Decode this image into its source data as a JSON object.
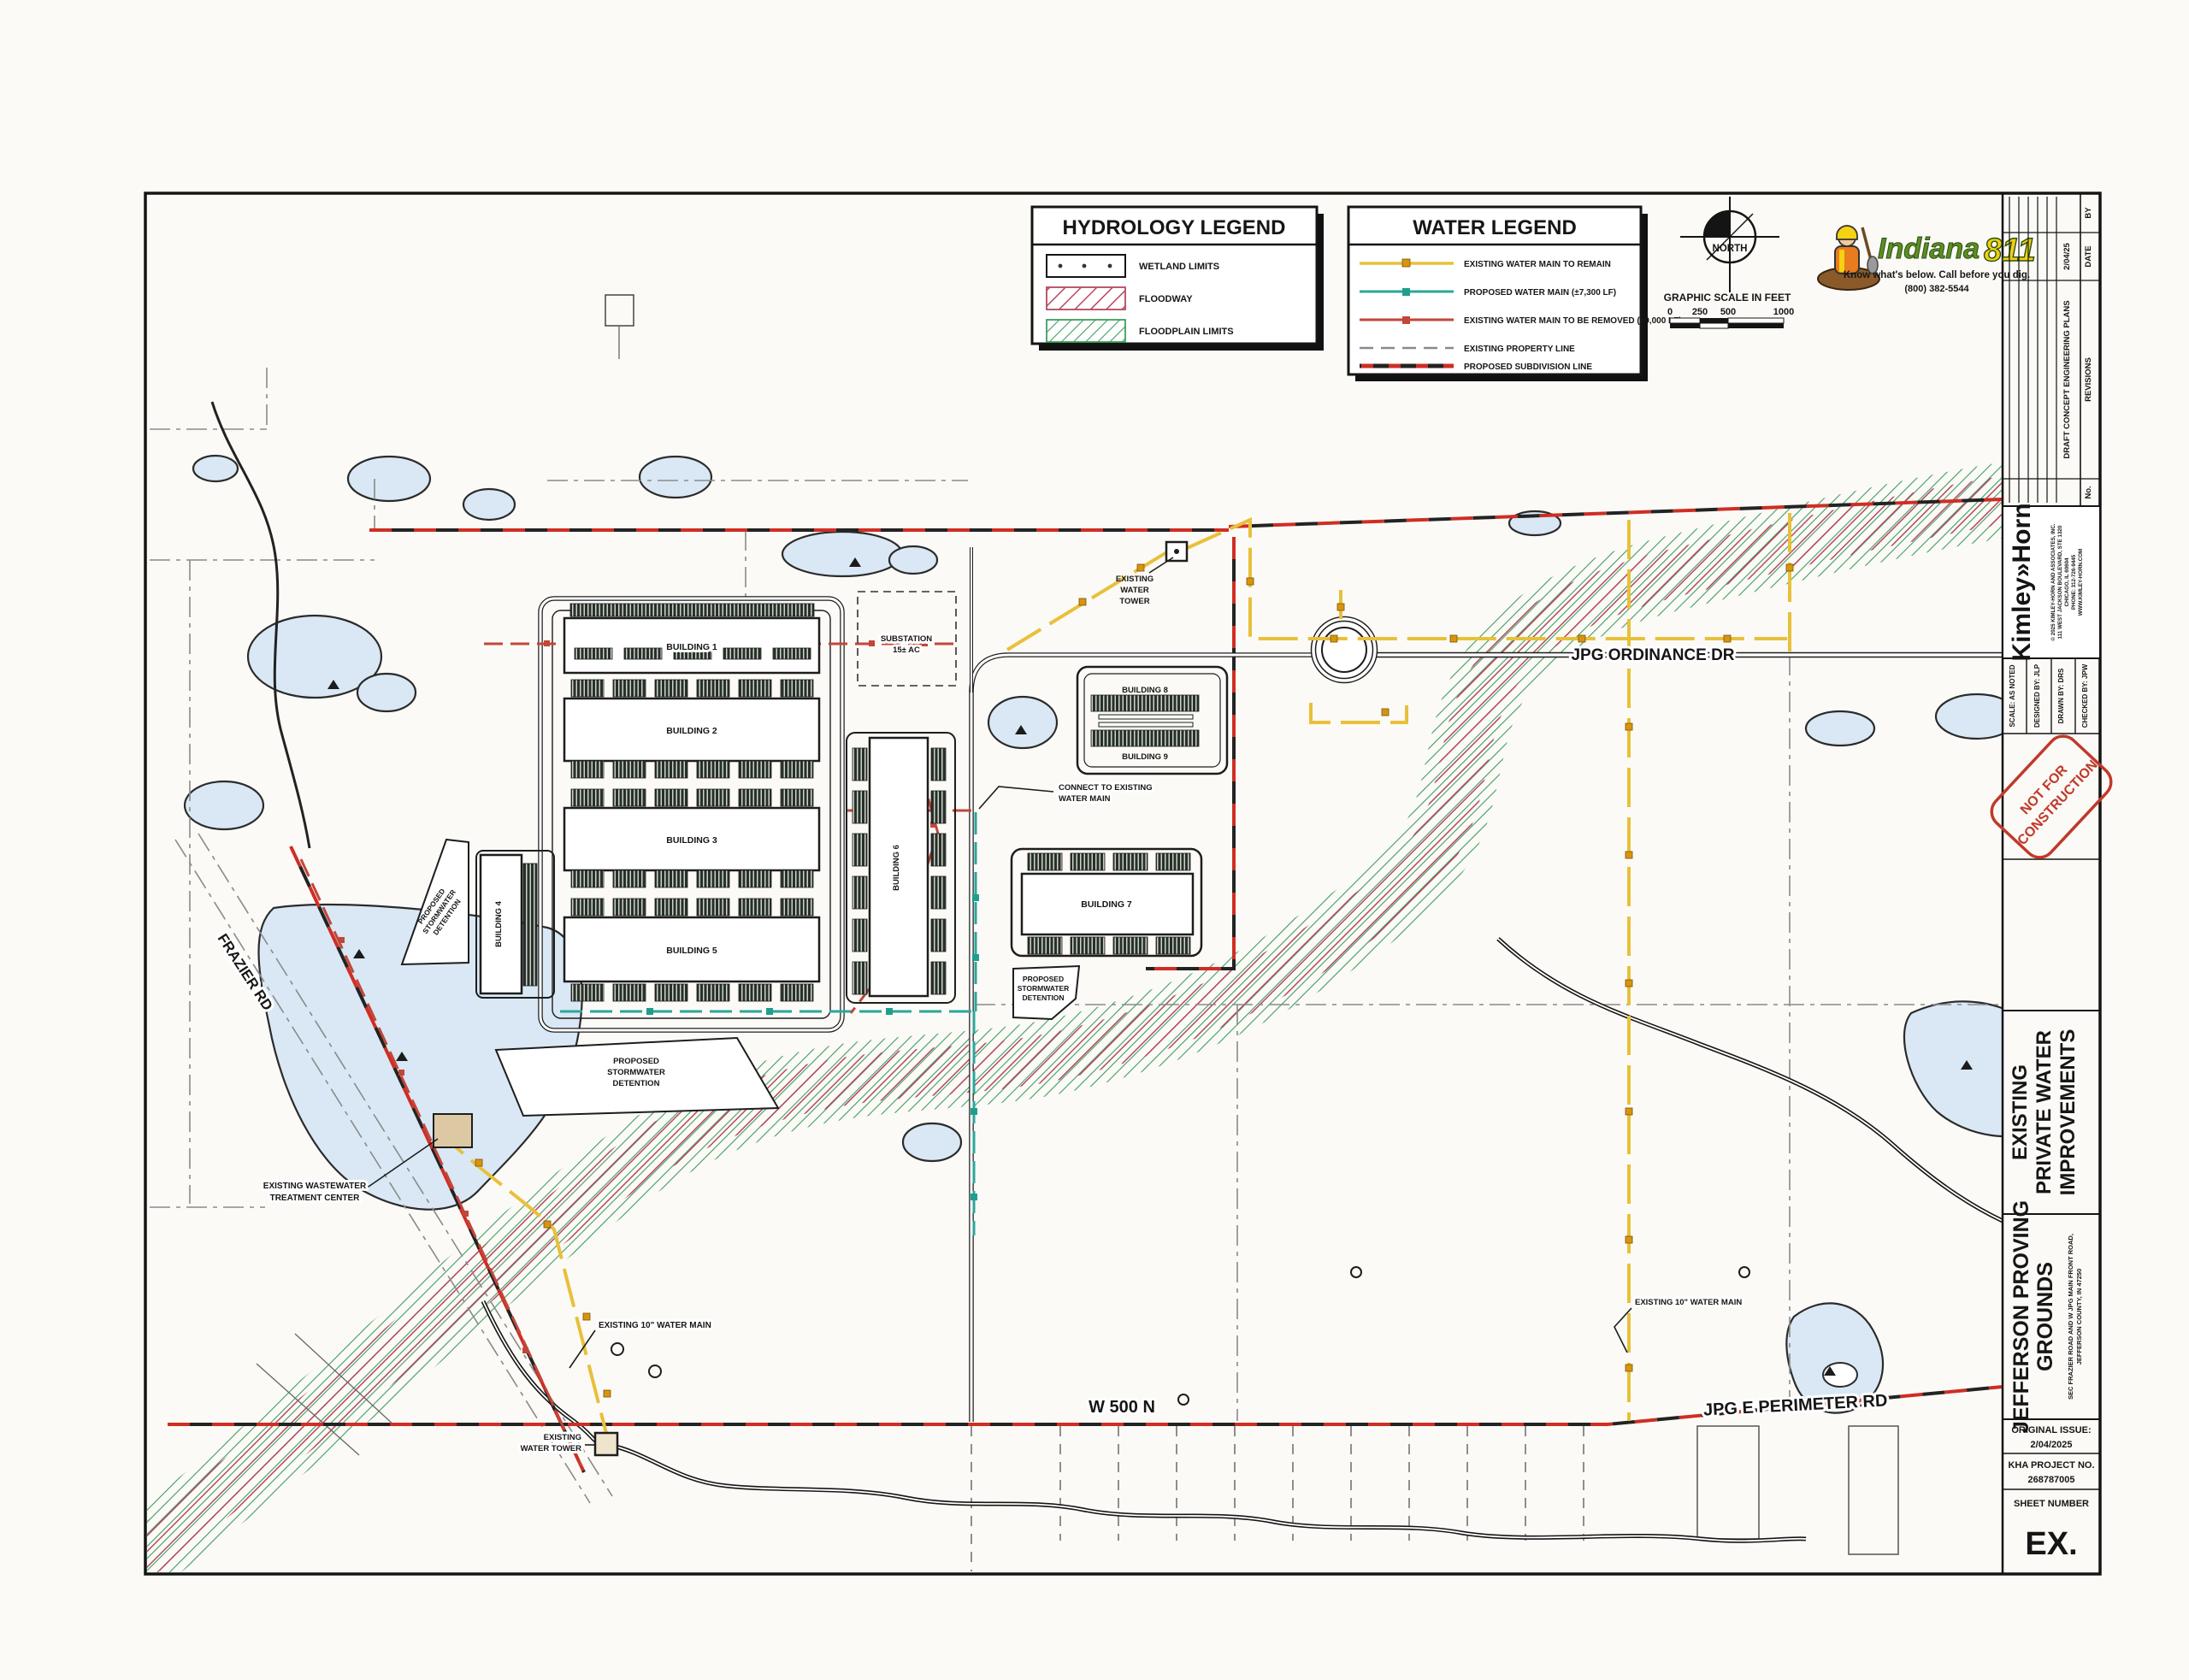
{
  "sheet": {
    "legends": {
      "hydrology": {
        "title": "HYDROLOGY LEGEND",
        "items": [
          {
            "label": "WETLAND LIMITS"
          },
          {
            "label": "FLOODWAY"
          },
          {
            "label": "FLOODPLAIN LIMITS"
          }
        ]
      },
      "water": {
        "title": "WATER LEGEND",
        "items": [
          {
            "label": "EXISTING WATER MAIN TO REMAIN"
          },
          {
            "label": "PROPOSED WATER MAIN (±7,300 LF)"
          },
          {
            "label": "EXISTING WATER MAIN TO BE REMOVED (±9,000 LF)"
          },
          {
            "label": "EXISTING PROPERTY LINE"
          },
          {
            "label": "PROPOSED SUBDIVISION LINE"
          }
        ]
      }
    },
    "north": {
      "label": "NORTH"
    },
    "scalebar": {
      "title": "GRAPHIC SCALE IN FEET",
      "t0": "0",
      "t1": "250",
      "t2": "500",
      "t3": "1000"
    },
    "indiana811": {
      "brand": "Indiana",
      "number": "811",
      "tagline": "Know what's below. Call before you dig.",
      "phone": "(800) 382-5544"
    },
    "titleblock": {
      "revisions": {
        "no": "No.",
        "revisions": "REVISIONS",
        "date": "DATE",
        "by": "BY",
        "entry": "DRAFT CONCEPT ENGINEERING PLANS",
        "entry_date": "2/04/25"
      },
      "firm": {
        "name": "Kimley»Horn",
        "line1": "© 2025 KIMLEY-HORN AND ASSOCIATES, INC.",
        "line2": "111 WEST JACKSON BOULEVARD, STE 1320",
        "line3": "CHICAGO, IL 60604",
        "line4": "PHONE: 312-726-9445",
        "line5": "WWW.KIMLEY-HORN.COM"
      },
      "fields": {
        "scale": "SCALE: AS NOTED",
        "designed": "DESIGNED BY: JLP",
        "drawn": "DRAWN BY: DRS",
        "checked": "CHECKED BY: JPW"
      },
      "stamp": {
        "line1": "NOT FOR",
        "line2": "CONSTRUCTION"
      },
      "sheet_title": {
        "line1": "EXISTING",
        "line2": "PRIVATE WATER",
        "line3": "IMPROVEMENTS"
      },
      "project": {
        "line1": "JEFFERSON PROVING",
        "line2": "GROUNDS",
        "sub1": "SEC FRAZIER ROAD AND W JPG MAIN FRONT ROAD,",
        "sub2": "JEFFERSON COUNTY, IN 47250"
      },
      "issue": {
        "label": "ORIGINAL ISSUE:",
        "date": "2/04/2025",
        "project_label": "KHA PROJECT NO.",
        "project_no": "268787005",
        "sheet_label": "SHEET NUMBER",
        "sheet_no": "EX."
      }
    },
    "map": {
      "roads": {
        "jpg_ordinance": "JPG ORDINANCE DR",
        "w500n": "W 500 N",
        "jpg_e_perimeter": "JPG E PERIMETER RD",
        "frazier": "FRAZIER RD"
      },
      "buildings": {
        "b1": "BUILDING 1",
        "b2": "BUILDING 2",
        "b3": "BUILDING 3",
        "b4": "BUILDING 4",
        "b5": "BUILDING 5",
        "b6": "BUILDING 6",
        "b7": "BUILDING 7",
        "b8": "BUILDING 8",
        "b9": "BUILDING 9"
      },
      "labels": {
        "substation1": "SUBSTATION",
        "substation2": "15± AC",
        "water_tower_top1": "EXISTING",
        "water_tower_top2": "WATER",
        "water_tower_top3": "TOWER",
        "connect1": "CONNECT TO EXISTING",
        "connect2": "WATER MAIN",
        "det1": "PROPOSED",
        "det2": "STORMWATER",
        "det3": "DETENTION",
        "wwtc1": "EXISTING WASTEWATER",
        "wwtc2": "TREATMENT CENTER",
        "main10_left": "EXISTING 10\" WATER MAIN",
        "main10_right": "EXISTING 10\" WATER MAIN",
        "water_tower_bot1": "EXISTING",
        "water_tower_bot2": "WATER TOWER"
      }
    },
    "colors": {
      "existing_water_main": "#e8c03a",
      "proposed_water_main": "#2aa79b",
      "removed_water_main": "#c2463b",
      "subdivision_line": "#cf2e24",
      "property_line": "#8a8a8a",
      "floodway_hatch": "#b5495f",
      "floodplain_hatch": "#3f9e5f",
      "wetland_fill": "#d9e8f4",
      "not_for_construction": "#c0392b",
      "indiana_green": "#5a8f23",
      "indiana_yellow": "#f0d010"
    }
  }
}
